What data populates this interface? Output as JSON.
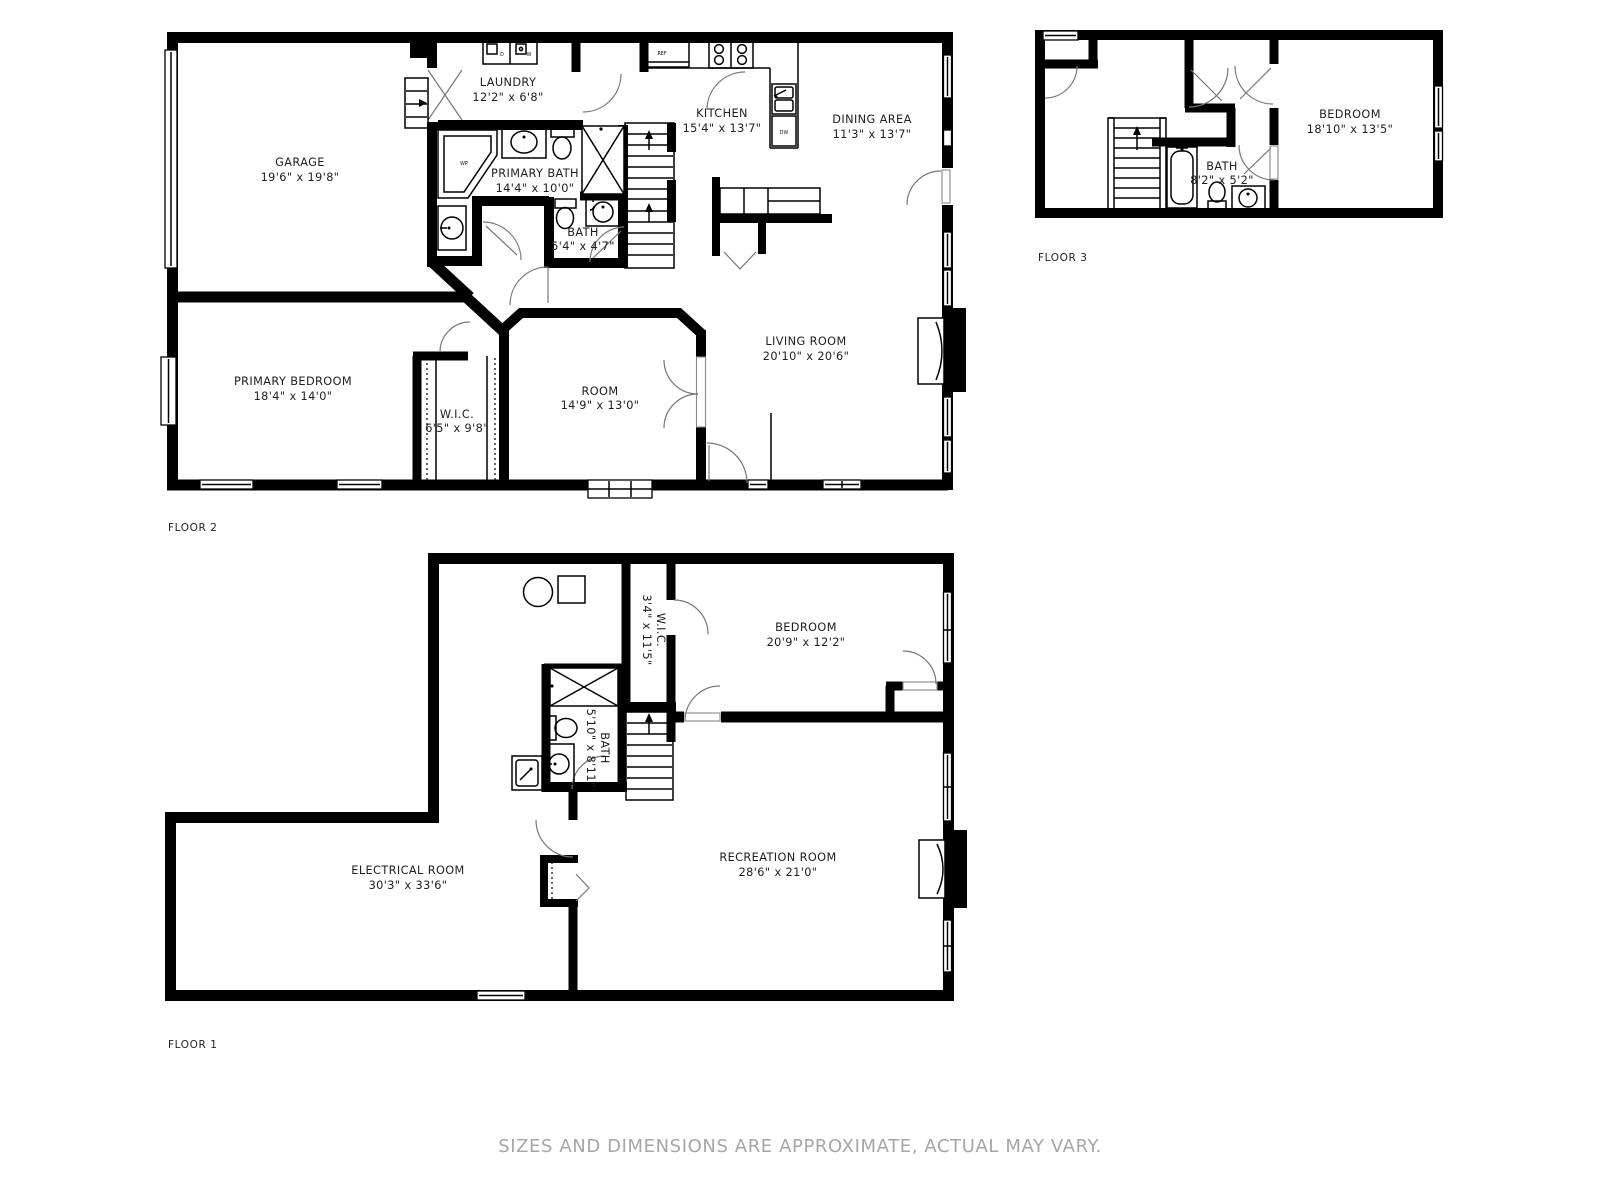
{
  "page": {
    "background": "#ffffff",
    "wall_color": "#000000",
    "label_color": "#1e1e1e",
    "muted_color": "#a6a6a6"
  },
  "disclaimer": "SIZES AND DIMENSIONS ARE APPROXIMATE, ACTUAL MAY VARY.",
  "floor2": {
    "label": "FLOOR 2",
    "rooms": {
      "garage": {
        "name": "GARAGE",
        "dims": "19'6\" x 19'8\""
      },
      "laundry": {
        "name": "LAUNDRY",
        "dims": "12'2\" x 6'8\""
      },
      "kitchen": {
        "name": "KITCHEN",
        "dims": "15'4\" x 13'7\""
      },
      "dining": {
        "name": "DINING AREA",
        "dims": "11'3\" x 13'7\""
      },
      "primary_bath": {
        "name": "PRIMARY BATH",
        "dims": "14'4\" x 10'0\""
      },
      "bath": {
        "name": "BATH",
        "dims": "5'4\" x 4'7\""
      },
      "living": {
        "name": "LIVING ROOM",
        "dims": "20'10\" x 20'6\""
      },
      "primary_bedroom": {
        "name": "PRIMARY BEDROOM",
        "dims": "18'4\" x 14'0\""
      },
      "wic": {
        "name": "W.I.C.",
        "dims": "6'5\" x 9'8\""
      },
      "room": {
        "name": "ROOM",
        "dims": "14'9\" x 13'0\""
      }
    },
    "fixtures": {
      "dryer": "D",
      "washer": "W",
      "fridge": "REF",
      "dishwasher": "DW",
      "whirlpool": "WP"
    }
  },
  "floor3": {
    "label": "FLOOR 3",
    "rooms": {
      "bedroom": {
        "name": "BEDROOM",
        "dims": "18'10\" x 13'5\""
      },
      "bath": {
        "name": "BATH",
        "dims": "8'2\" x 5'2\""
      }
    }
  },
  "floor1": {
    "label": "FLOOR 1",
    "rooms": {
      "bedroom": {
        "name": "BEDROOM",
        "dims": "20'9\" x 12'2\""
      },
      "recreation": {
        "name": "RECREATION ROOM",
        "dims": "28'6\" x 21'0\""
      },
      "electrical": {
        "name": "ELECTRICAL ROOM",
        "dims": "30'3\" x 33'6\""
      },
      "wic": {
        "name": "W.I.C.",
        "dims": "3'4\" x 11'5\""
      },
      "bath": {
        "name": "BATH",
        "dims": "5'10\" x 8'11\""
      }
    }
  }
}
